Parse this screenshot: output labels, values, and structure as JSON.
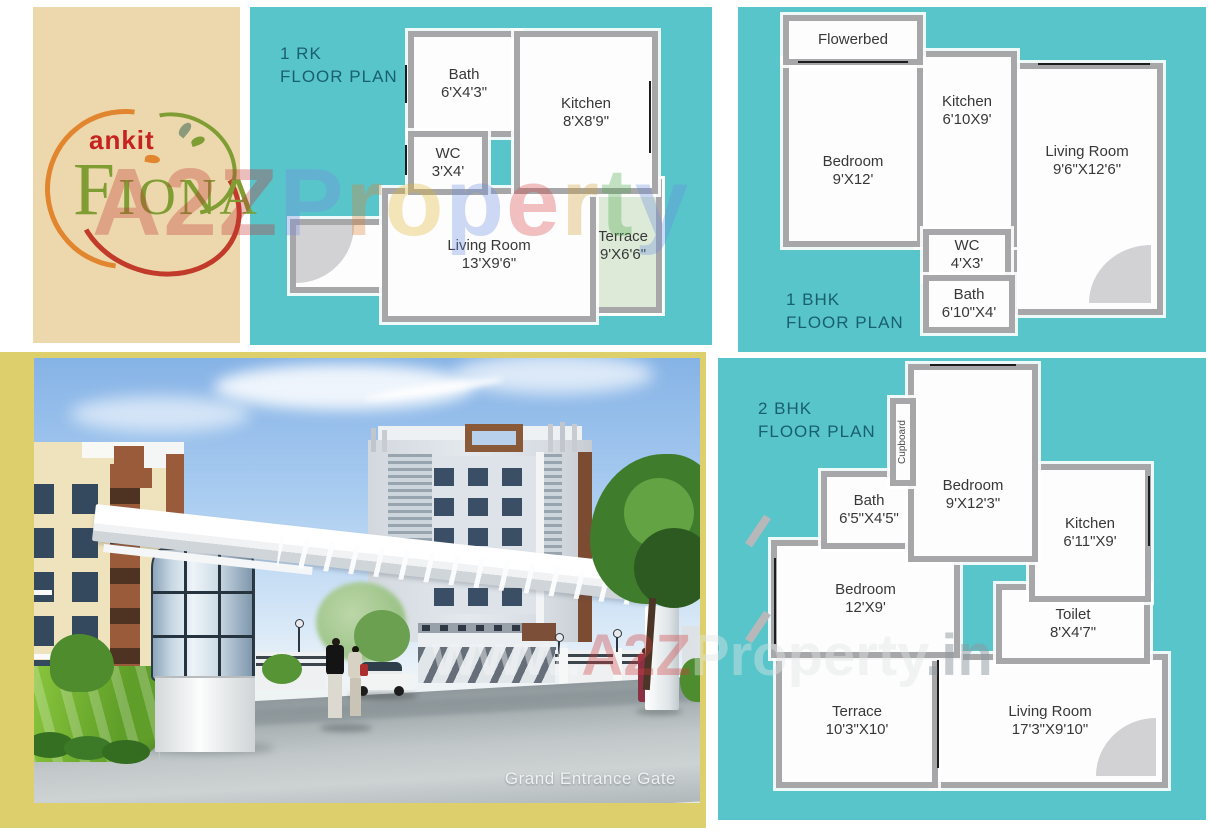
{
  "brand": {
    "company": "ankit",
    "project": "FIONA"
  },
  "panels": {
    "rk1": {
      "title_line1": "1 RK",
      "title_line2": "FLOOR PLAN",
      "rooms": [
        {
          "name": "Bath",
          "dims": "6'X4'3\""
        },
        {
          "name": "WC",
          "dims": "3'X4'"
        },
        {
          "name": "Kitchen",
          "dims": "8'X8'9\""
        },
        {
          "name": "Living Room",
          "dims": "13'X9'6\""
        },
        {
          "name": "Terrace",
          "dims": "9'X6'6\""
        }
      ]
    },
    "bhk1": {
      "title_line1": "1 BHK",
      "title_line2": "FLOOR PLAN",
      "rooms": [
        {
          "name": "Flowerbed",
          "dims": ""
        },
        {
          "name": "Bedroom",
          "dims": "9'X12'"
        },
        {
          "name": "Kitchen",
          "dims": "6'10X9'"
        },
        {
          "name": "Living Room",
          "dims": "9'6\"X12'6\""
        },
        {
          "name": "WC",
          "dims": "4'X3'"
        },
        {
          "name": "Bath",
          "dims": "6'10\"X4'"
        }
      ]
    },
    "bhk2": {
      "title_line1": "2 BHK",
      "title_line2": "FLOOR PLAN",
      "rooms": [
        {
          "name": "Cupboard",
          "dims": ""
        },
        {
          "name": "Bedroom",
          "dims": "9'X12'3\""
        },
        {
          "name": "Bath",
          "dims": "6'5\"X4'5\""
        },
        {
          "name": "Kitchen",
          "dims": "6'11\"X9'"
        },
        {
          "name": "Bedroom",
          "dims": "12'X9'"
        },
        {
          "name": "Toilet",
          "dims": "8'X4'7\""
        },
        {
          "name": "Terrace",
          "dims": "10'3\"X10'"
        },
        {
          "name": "Living Room",
          "dims": "17'3\"X9'10\""
        }
      ]
    }
  },
  "photo": {
    "caption": "Grand Entrance Gate"
  },
  "watermarks": {
    "a2z": "A2Z",
    "property": "Property",
    "property_colors": [
      "#7a8ae0",
      "#e08030",
      "#e0b428",
      "#6a8ce0",
      "#d84040",
      "#d0a030",
      "#48a848",
      "#6a8ce0"
    ],
    "www_prefix": "www.",
    "www_a2z": "A2Z",
    "www_property": "Property",
    "www_suffix": ".in"
  },
  "colors": {
    "teal": "#58c5cb",
    "beige": "#ecd8ac",
    "frame_yellow": "#ddd06c",
    "wall_gray": "#a7a7a9",
    "title_teal": "#19606e",
    "terrace_green": "#dcead7",
    "logo_red": "#c5231f",
    "logo_green": "#7f9d33"
  }
}
